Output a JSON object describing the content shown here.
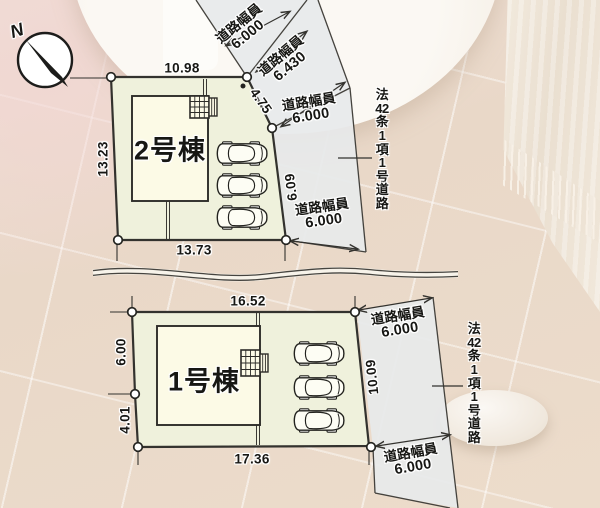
{
  "compass": {
    "north_label": "N"
  },
  "plot2": {
    "building_label": "2号棟",
    "dim_top": "10.98",
    "dim_left": "13.23",
    "dim_bottom": "13.73",
    "dim_slant": "4.75",
    "dim_right": "6.09"
  },
  "plot1": {
    "building_label": "1号棟",
    "dim_top": "16.52",
    "dim_left_upper": "6.00",
    "dim_left_lower": "4.01",
    "dim_bottom": "17.36",
    "dim_right": "10.09"
  },
  "road_labels": {
    "u1": {
      "caption": "道路幅員",
      "width": "6.000"
    },
    "u2": {
      "caption": "道路幅員",
      "width": "6.430"
    },
    "u3": {
      "caption": "道路幅員",
      "width": "6.000"
    },
    "u4": {
      "caption": "道路幅員",
      "width": "6.000"
    },
    "l1": {
      "caption": "道路幅員",
      "width": "6.000"
    },
    "l2": {
      "caption": "道路幅員",
      "width": "6.000"
    }
  },
  "road_designation": {
    "full_text": "法42条1項1号道路",
    "upper_lines": [
      "法",
      "42",
      "条",
      "1",
      "項",
      "1",
      "号",
      "道",
      "路"
    ],
    "lower_lines": [
      "法",
      "42",
      "条",
      "1",
      "項",
      "1",
      "号",
      "道",
      "路"
    ]
  },
  "colors": {
    "plot_fill": "#eff1dc",
    "building_fill": "#fcfae6",
    "road_fill": "#e7e9eb",
    "line": "#33322e"
  }
}
